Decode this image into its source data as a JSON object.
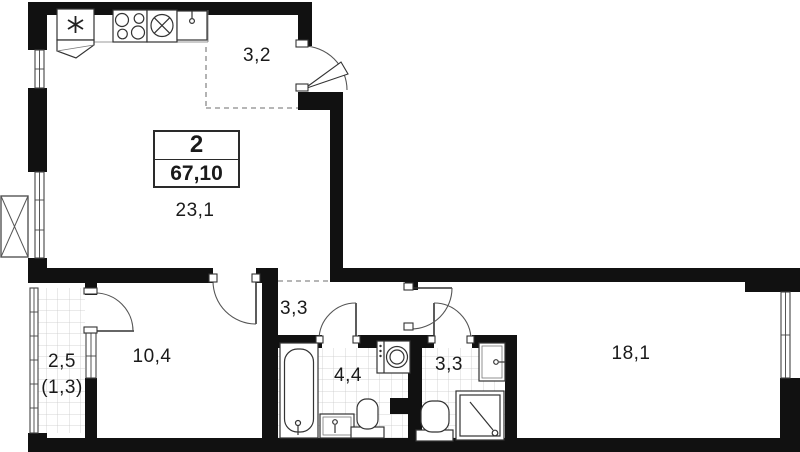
{
  "summary": {
    "rooms_count": "2",
    "total_area": "67,10"
  },
  "labels": {
    "entry_hall": "3,2",
    "kitchen_living": "23,1",
    "room1": "10,4",
    "hallway": "3,3",
    "loggia": "2,5",
    "loggia_reduced": "(1,3)",
    "bathroom": "4,4",
    "shower_room": "3,3",
    "bedroom": "18,1"
  },
  "icons": {
    "fridge": "six-spoke-asterisk",
    "stove": "four-burner-circles",
    "kitchen_sink": "circle-with-cross",
    "washbasin": "rect-with-faucet",
    "ac_basket": "crossed-rectangle",
    "shower": "square-with-diagonal-drain"
  },
  "colors": {
    "wall": "#111111",
    "background": "#ffffff",
    "fixture": "#333333",
    "tile": "#c9c9c9",
    "dash": "#8a8a8a",
    "text": "#1a1a1a"
  }
}
